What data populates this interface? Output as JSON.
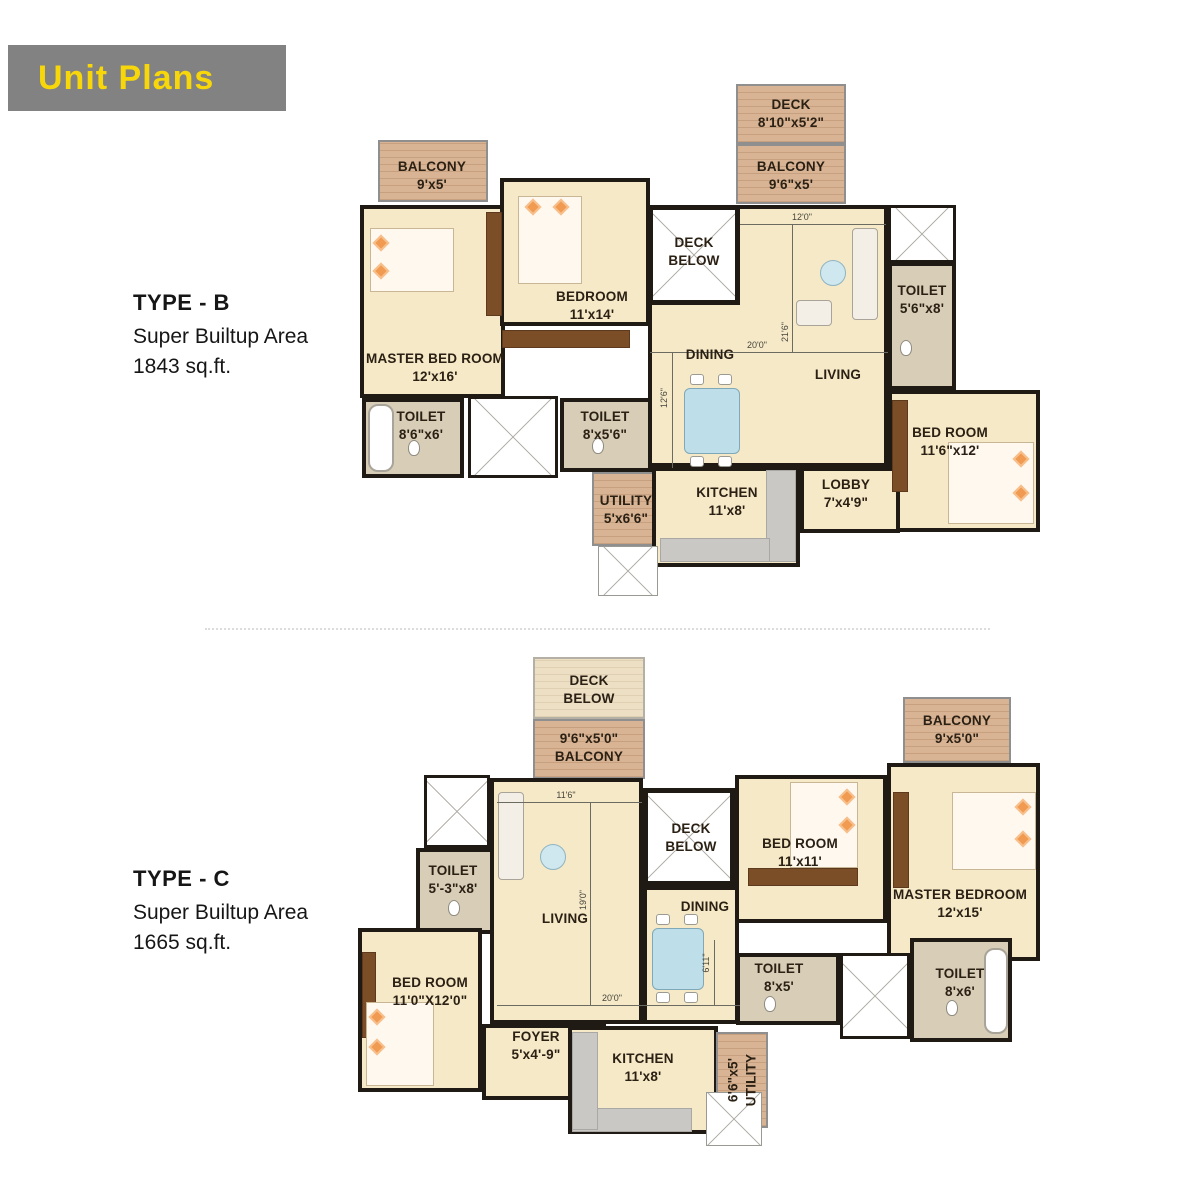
{
  "header": {
    "title": "Unit Plans"
  },
  "plans": {
    "typeB": {
      "title": "TYPE - B",
      "subtitle": "Super Builtup Area",
      "area": "1843 sq.ft.",
      "rooms": {
        "balconyTL": {
          "name": "BALCONY",
          "dim": "9'x5'"
        },
        "deck": {
          "name": "DECK",
          "dim": "8'10\"x5'2\""
        },
        "balconyTR": {
          "name": "BALCONY",
          "dim": "9'6\"x5'"
        },
        "master": {
          "name": "MASTER BED ROOM",
          "dim": "12'x16'"
        },
        "bedroom": {
          "name": "BEDROOM",
          "dim": "11'x14'"
        },
        "deckBelow": {
          "name": "DECK BELOW"
        },
        "dining": {
          "name": "DINING"
        },
        "living": {
          "name": "LIVING"
        },
        "toiletRight": {
          "name": "TOILET",
          "dim": "5'6\"x8'"
        },
        "bedroomRight": {
          "name": "BED ROOM",
          "dim": "11'6\"x12'"
        },
        "toiletLeft": {
          "name": "TOILET",
          "dim": "8'6\"x6'"
        },
        "toiletMid": {
          "name": "TOILET",
          "dim": "8'x5'6\""
        },
        "utility": {
          "name": "UTILITY",
          "dim": "5'x6'6\""
        },
        "kitchen": {
          "name": "KITCHEN",
          "dim": "11'x8'"
        },
        "lobby": {
          "name": "LOBBY",
          "dim": "7'x4'9\""
        }
      },
      "dims": {
        "d1": "12'0\"",
        "d2": "20'0\"",
        "d3": "21'6\"",
        "d4": "12'6\""
      }
    },
    "typeC": {
      "title": "TYPE - C",
      "subtitle": "Super Builtup Area",
      "area": "1665 sq.ft.",
      "rooms": {
        "deckBelowTop": {
          "name": "DECK BELOW"
        },
        "balconyTop": {
          "name": "BALCONY",
          "dim": "9'6\"x5'0\""
        },
        "balconyTR": {
          "name": "BALCONY",
          "dim": "9'x5'0\""
        },
        "toiletTL": {
          "name": "TOILET",
          "dim": "5'-3\"x8'"
        },
        "living": {
          "name": "LIVING"
        },
        "deckBelowMid": {
          "name": "DECK BELOW"
        },
        "dining": {
          "name": "DINING"
        },
        "bedroomMid": {
          "name": "BED ROOM",
          "dim": "11'x11'"
        },
        "master": {
          "name": "MASTER BEDROOM",
          "dim": "12'x15'"
        },
        "bedroomBL": {
          "name": "BED ROOM",
          "dim": "11'0\"X12'0\""
        },
        "foyer": {
          "name": "FOYER",
          "dim": "5'x4'-9\""
        },
        "kitchen": {
          "name": "KITCHEN",
          "dim": "11'x8'"
        },
        "toiletB1": {
          "name": "TOILET",
          "dim": "8'x5'"
        },
        "toiletB2": {
          "name": "TOILET",
          "dim": "8'x6'"
        },
        "utility": {
          "name": "UTILITY",
          "dim": "6'6\"x5'"
        }
      },
      "dims": {
        "d1": "11'6\"",
        "d2": "19'0\"",
        "d3": "20'0\"",
        "d4": "6'11\""
      }
    }
  },
  "colors": {
    "banner_bg": "#828282",
    "banner_text": "#f8d70a",
    "wall": "#1f1a14",
    "room_fill": "#f6e9c7",
    "balcony_fill": "#d8b494",
    "toilet_fill": "#d8cdb6",
    "counter_gray": "#c9c8c4",
    "wood_accent": "#7c4e28",
    "table_blue": "#bedfe9",
    "pillow_orange": "#f09a52"
  }
}
